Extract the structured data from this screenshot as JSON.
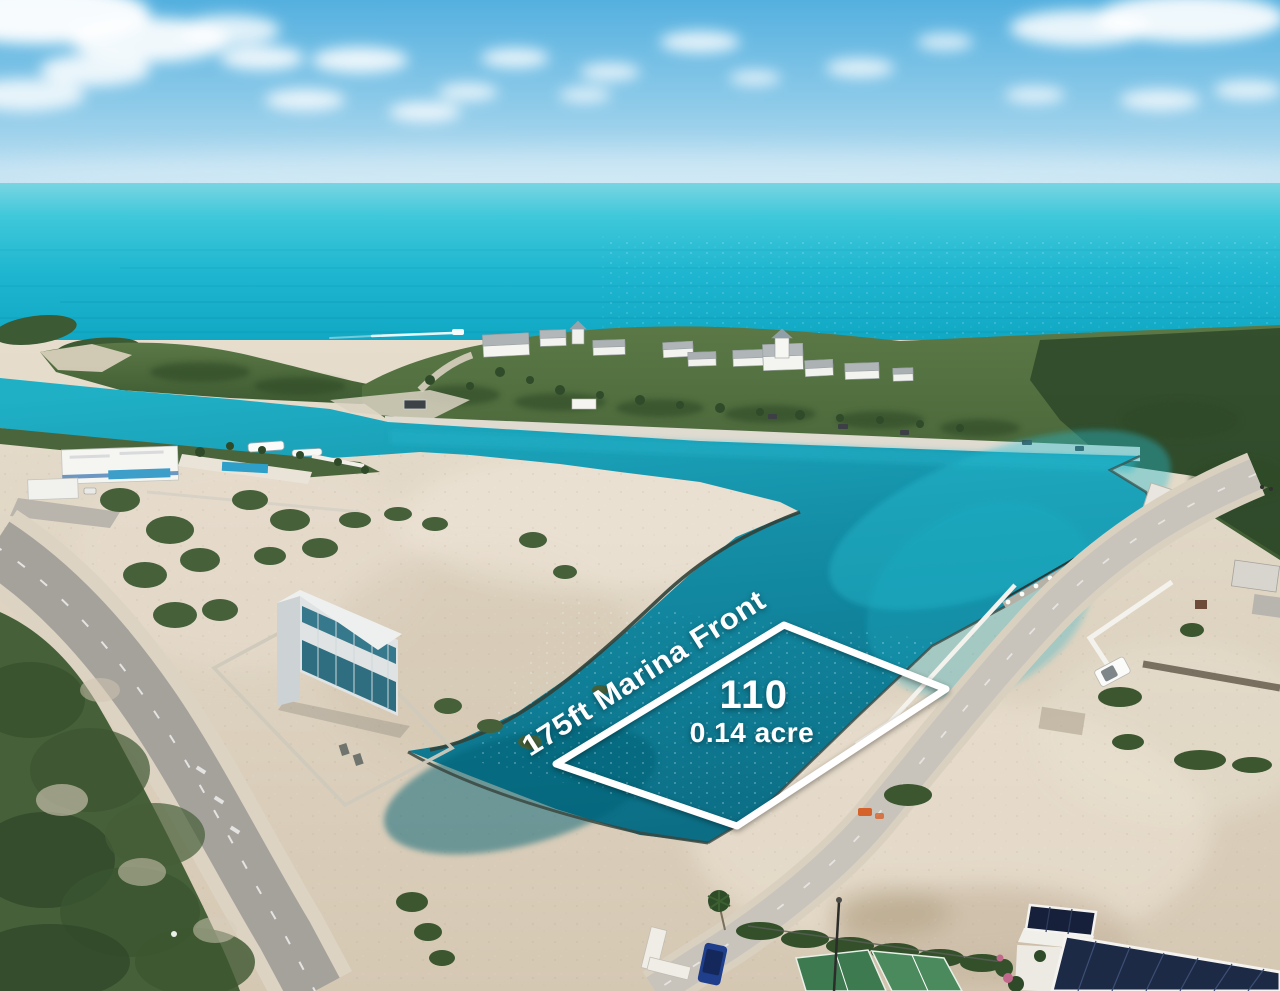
{
  "overlay": {
    "marina_front_label": "175ft Marina Front",
    "lot_number": "110",
    "lot_area": "0.14 acre",
    "outline_color": "#ffffff"
  },
  "palette": {
    "sky": "#5cb4e1",
    "sky_horizon": "#c6e3f2",
    "ocean_turquoise": "#1db5cf",
    "canal_teal": "#0e7b93",
    "canal_bright": "#1fb0c6",
    "sand": "#ddd2c0",
    "scrub_green": "#46603a",
    "island_green": "#4a683c",
    "road_gray": "#a5a29c",
    "concrete_road": "#c8c4bc"
  }
}
